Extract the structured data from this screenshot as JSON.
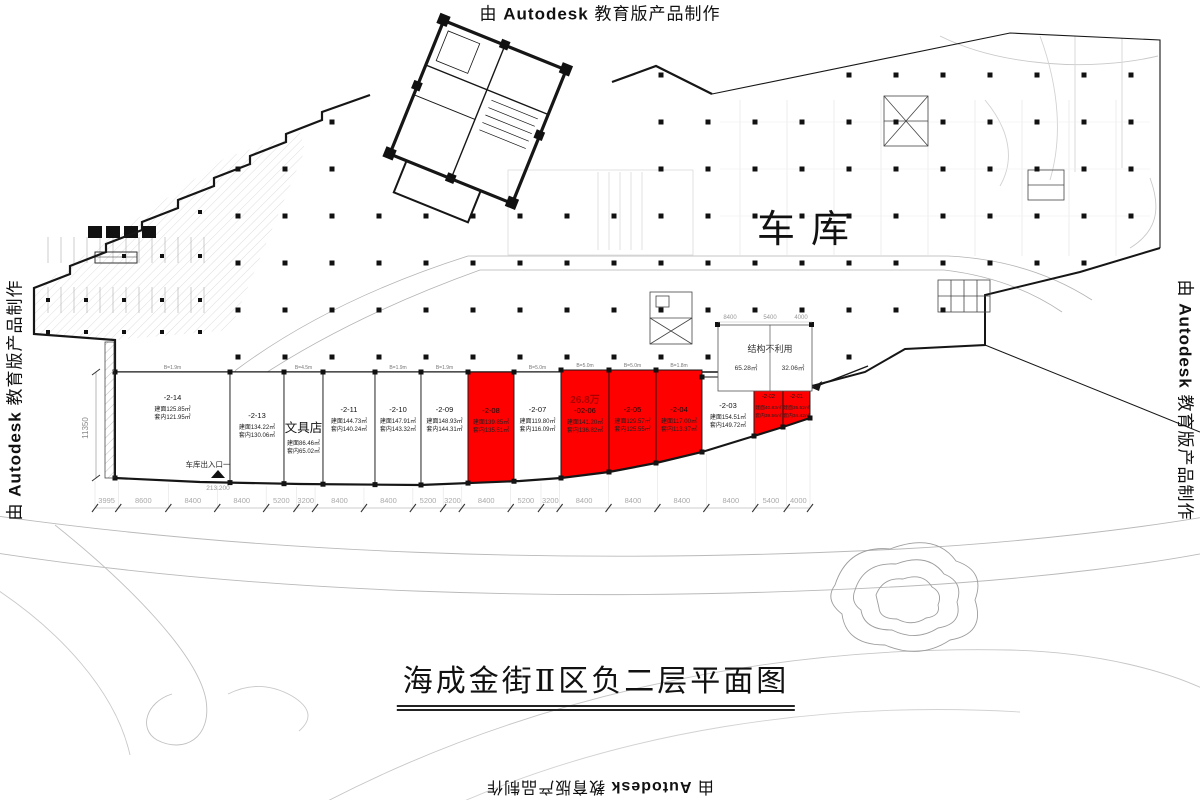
{
  "watermark": {
    "pre": "由",
    "brand": "Autodesk",
    "post": "教育版产品制作"
  },
  "title": "海成金街Ⅱ区负二层平面图",
  "garage_label": "车库",
  "entrance": {
    "label": "车库出入口一",
    "elevation": "213.200"
  },
  "left_dim": "11350",
  "unused_structure": {
    "label": "结构不利用",
    "area1": "65.28㎡",
    "area2": "32.06㎡"
  },
  "upper_dims": [
    "8400",
    "5400",
    "4000"
  ],
  "dimensions": [
    "3995",
    "8600",
    "8400",
    "8400",
    "5200",
    "3200",
    "8400",
    "8400",
    "5200",
    "3200",
    "8400",
    "5200",
    "3200",
    "8400",
    "8400",
    "8400",
    "8400",
    "5400",
    "4000"
  ],
  "units": [
    {
      "id": "-2-14",
      "area": "建面125.85㎡",
      "inner": "套内121.95㎡",
      "red": false,
      "b": "B=1.9m"
    },
    {
      "id": "-2-13",
      "area": "建面134.22㎡",
      "inner": "套内130.06㎡",
      "red": false
    },
    {
      "id": "文具店",
      "area": "建面86.46㎡",
      "inner": "套内65.02㎡",
      "red": false,
      "shop": true,
      "b": "B=4.5m"
    },
    {
      "id": "-2-11",
      "area": "建面144.73㎡",
      "inner": "套内140.24㎡",
      "red": false
    },
    {
      "id": "-2-10",
      "area": "建面147.91㎡",
      "inner": "套内143.32㎡",
      "red": false,
      "b": "B=1.9m"
    },
    {
      "id": "-2-09",
      "area": "建面148.93㎡",
      "inner": "套内144.31㎡",
      "red": false,
      "b": "B=1.9m"
    },
    {
      "id": "-2-08",
      "area": "建面139.85㎡",
      "inner": "套内135.51㎡",
      "red": true
    },
    {
      "id": "-2-07",
      "area": "建面119.80㎡",
      "inner": "套内116.09㎡",
      "red": false,
      "b": "B=5.0m"
    },
    {
      "id": "-02-06",
      "area": "建面141.20㎡",
      "inner": "套内136.82㎡",
      "red": true,
      "note": "26.8万",
      "b": "B=5.0m"
    },
    {
      "id": "-2-05",
      "area": "建面129.57㎡",
      "inner": "套内125.55㎡",
      "red": true,
      "b": "B=5.0m"
    },
    {
      "id": "-2-04",
      "area": "建面117.00㎡",
      "inner": "套内113.37㎡",
      "red": true,
      "b": "B=1.8m"
    },
    {
      "id": "-2-03",
      "area": "建面154.51㎡",
      "inner": "套内149.72㎡",
      "red": false
    },
    {
      "id": "-2-02",
      "area": "建面40.83㎡",
      "inner": "套内39.56㎡",
      "red": true,
      "b": "B=3.2m"
    },
    {
      "id": "-2-01",
      "area": "建面35.52㎡",
      "inner": "套内34.42㎡",
      "red": true,
      "b": "B=3.2m"
    }
  ],
  "colors": {
    "unit_red": "#ff0000",
    "note_red": "#aa0000",
    "line_dark": "#161616",
    "line_light": "#aaaaaa"
  }
}
